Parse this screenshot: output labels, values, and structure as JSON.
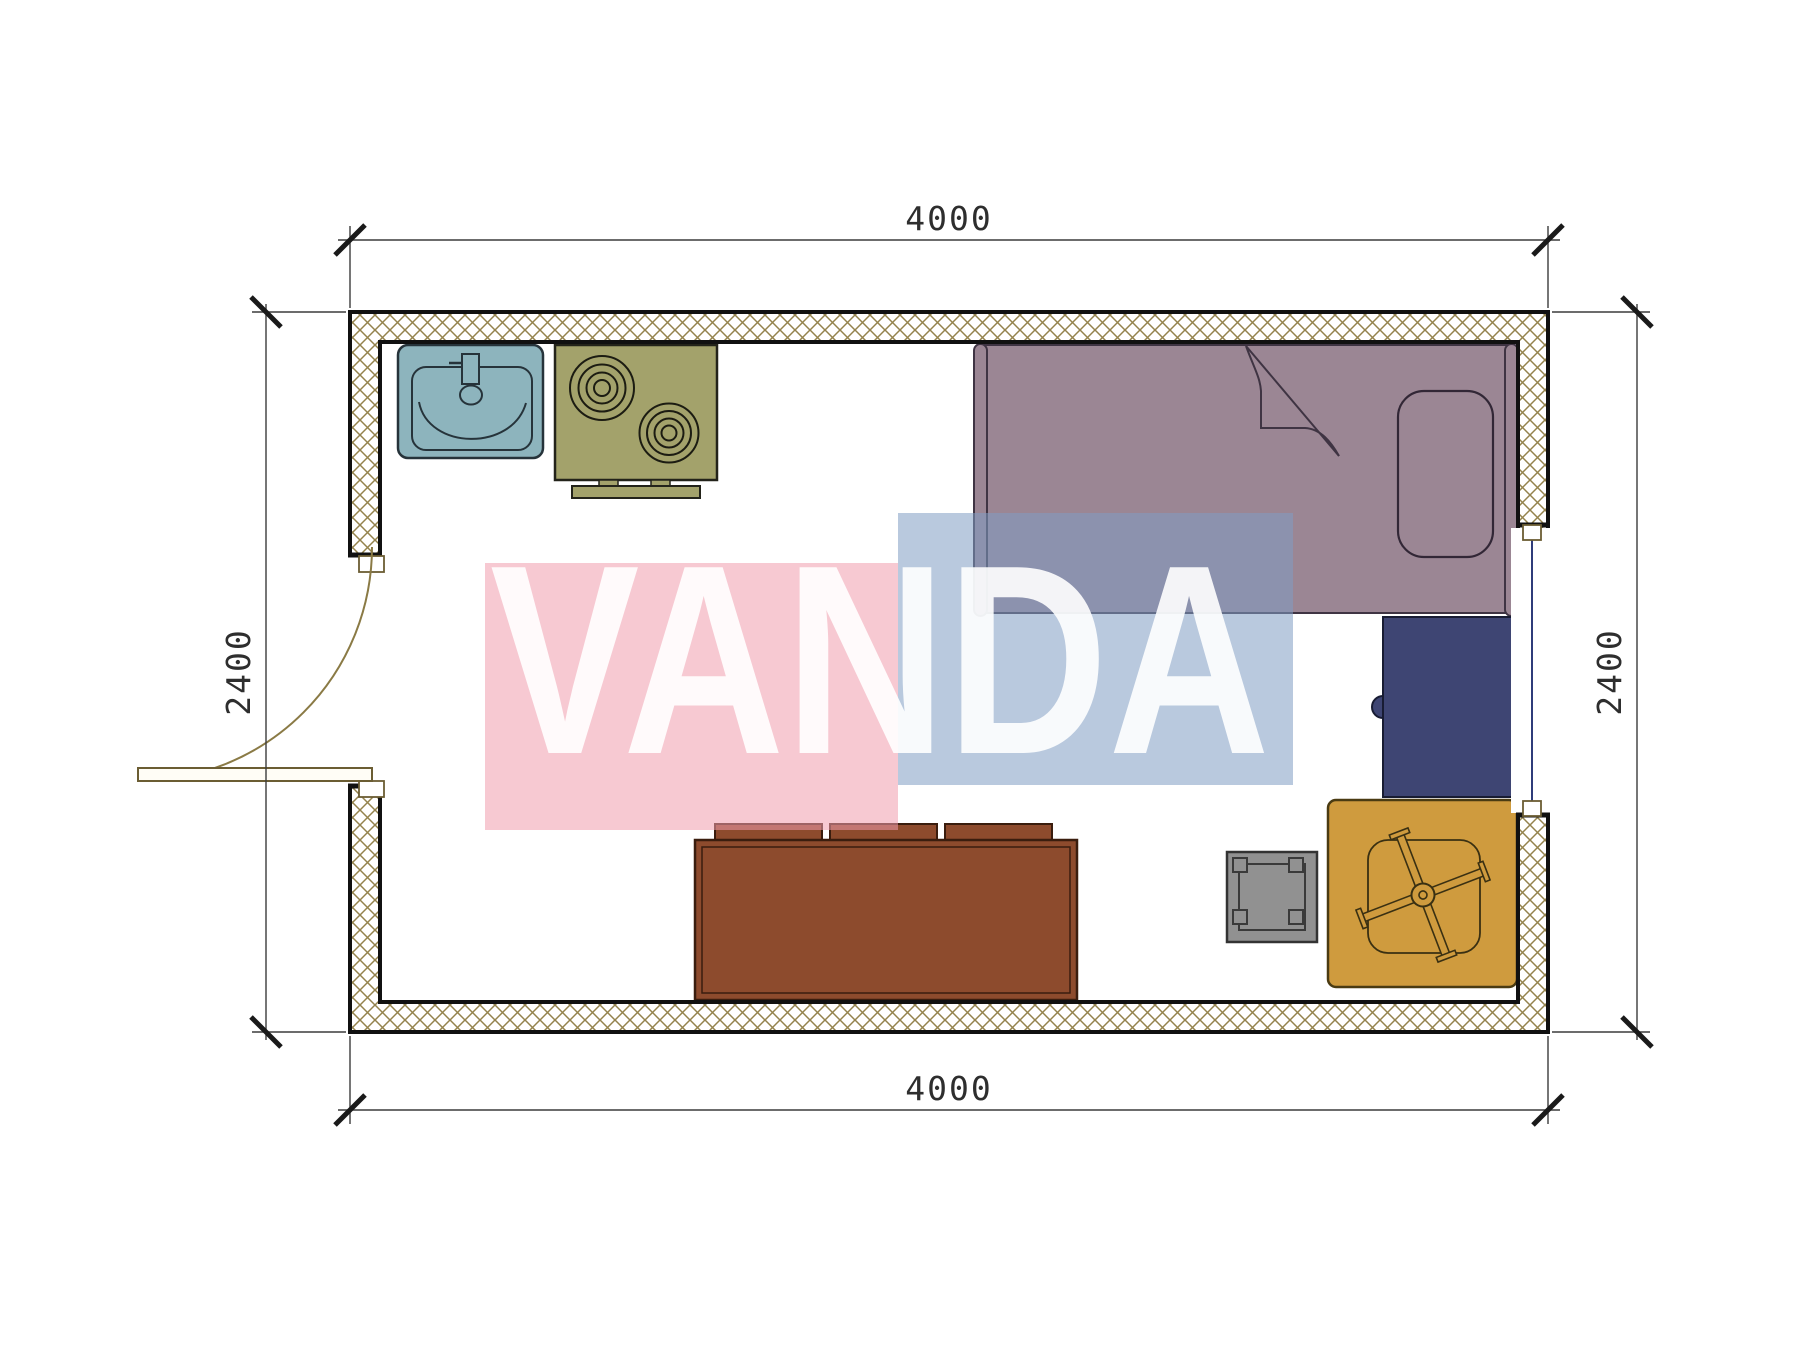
{
  "plan": {
    "watermark": {
      "text": "VANDA",
      "text_color": "#ffffff"
    },
    "dims": {
      "top": "4000",
      "bottom": "4000",
      "left": "2400",
      "right": "2400"
    },
    "furniture": [
      "sink",
      "cooktop-stove",
      "single-bed",
      "desk",
      "stool",
      "office-chair-on-mat",
      "sofa"
    ],
    "colors": {
      "wall_hatch": "#94834d",
      "wall_outline": "#111111",
      "door": "#8a7a45",
      "door_jamb": "#6b5d33",
      "window_glass": "#2f3c7a",
      "dimension": "#3a3a3a",
      "tick": "#1a1a1a",
      "sink": "#8db4bd",
      "stove": "#a3a26b",
      "bed": "#9b8694",
      "desk": "#3e4573",
      "sofa": "#8d4b2d",
      "stool": "#919191",
      "chair_mat": "#cf9b3e",
      "watermark_pink": "#f09dad",
      "watermark_blue": "#809dc3"
    }
  }
}
